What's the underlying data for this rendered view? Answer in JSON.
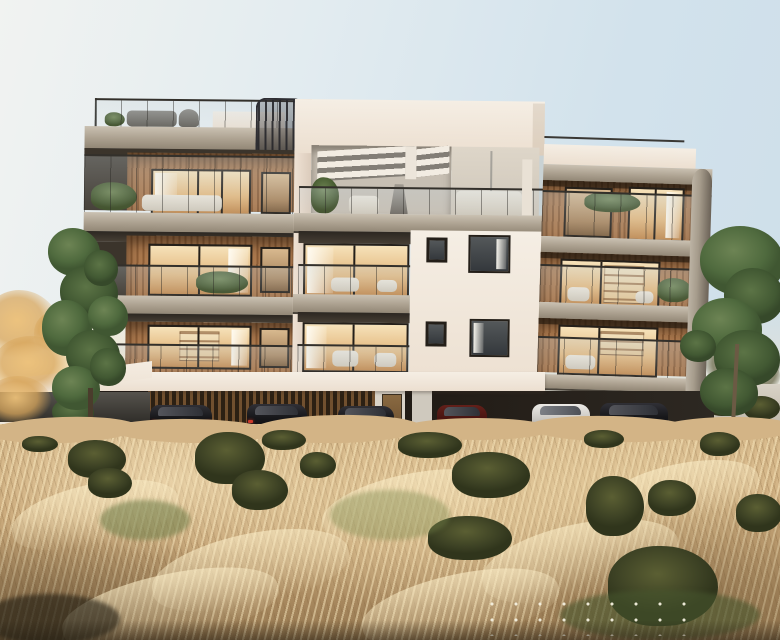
{
  "scene": {
    "kind": "architectural-exterior-render",
    "subject": "Modern four-level apartment building at dusk with warm lit interiors, rooftop terrace with white pergola louvers and spiral staircase, glass balustrade balconies, open pilotis parking with six cars, and a wind-swept dry golden grass meadow in the foreground",
    "wings": [
      "left-concrete-balcony-wing",
      "center-white-volume",
      "right-timber-clad-wing"
    ],
    "floors_visible": 4,
    "vehicle_colors": [
      "black",
      "black",
      "black",
      "maroon",
      "silver",
      "black"
    ],
    "vegetation": [
      "autumn-tree-left",
      "green-tree-left",
      "green-tree-right",
      "cypress",
      "meadow-bushes",
      "balcony-planters"
    ]
  },
  "palette": {
    "sky_blue": "#d2e2ec",
    "sky_warm_white": "#f1f3f1",
    "facade_white": "#f5eee4",
    "slab_concrete": "#aba08f",
    "wood_light": "#aa784d",
    "wood_dark": "#8a5c36",
    "glow_hi": "#f6e2ba",
    "glow_mid": "#e3b87e",
    "glow_lo": "#c08a52",
    "rail_line": "#33302b",
    "grass_light": "#dabd8f",
    "grass_mid": "#c5a476",
    "grass_deep": "#92754e",
    "bush_olive": "#5b5f33",
    "tree_green": "#4f6a3e",
    "car_black": "#17171a",
    "car_silver": "#cbc8c3",
    "car_maroon": "#471410"
  }
}
